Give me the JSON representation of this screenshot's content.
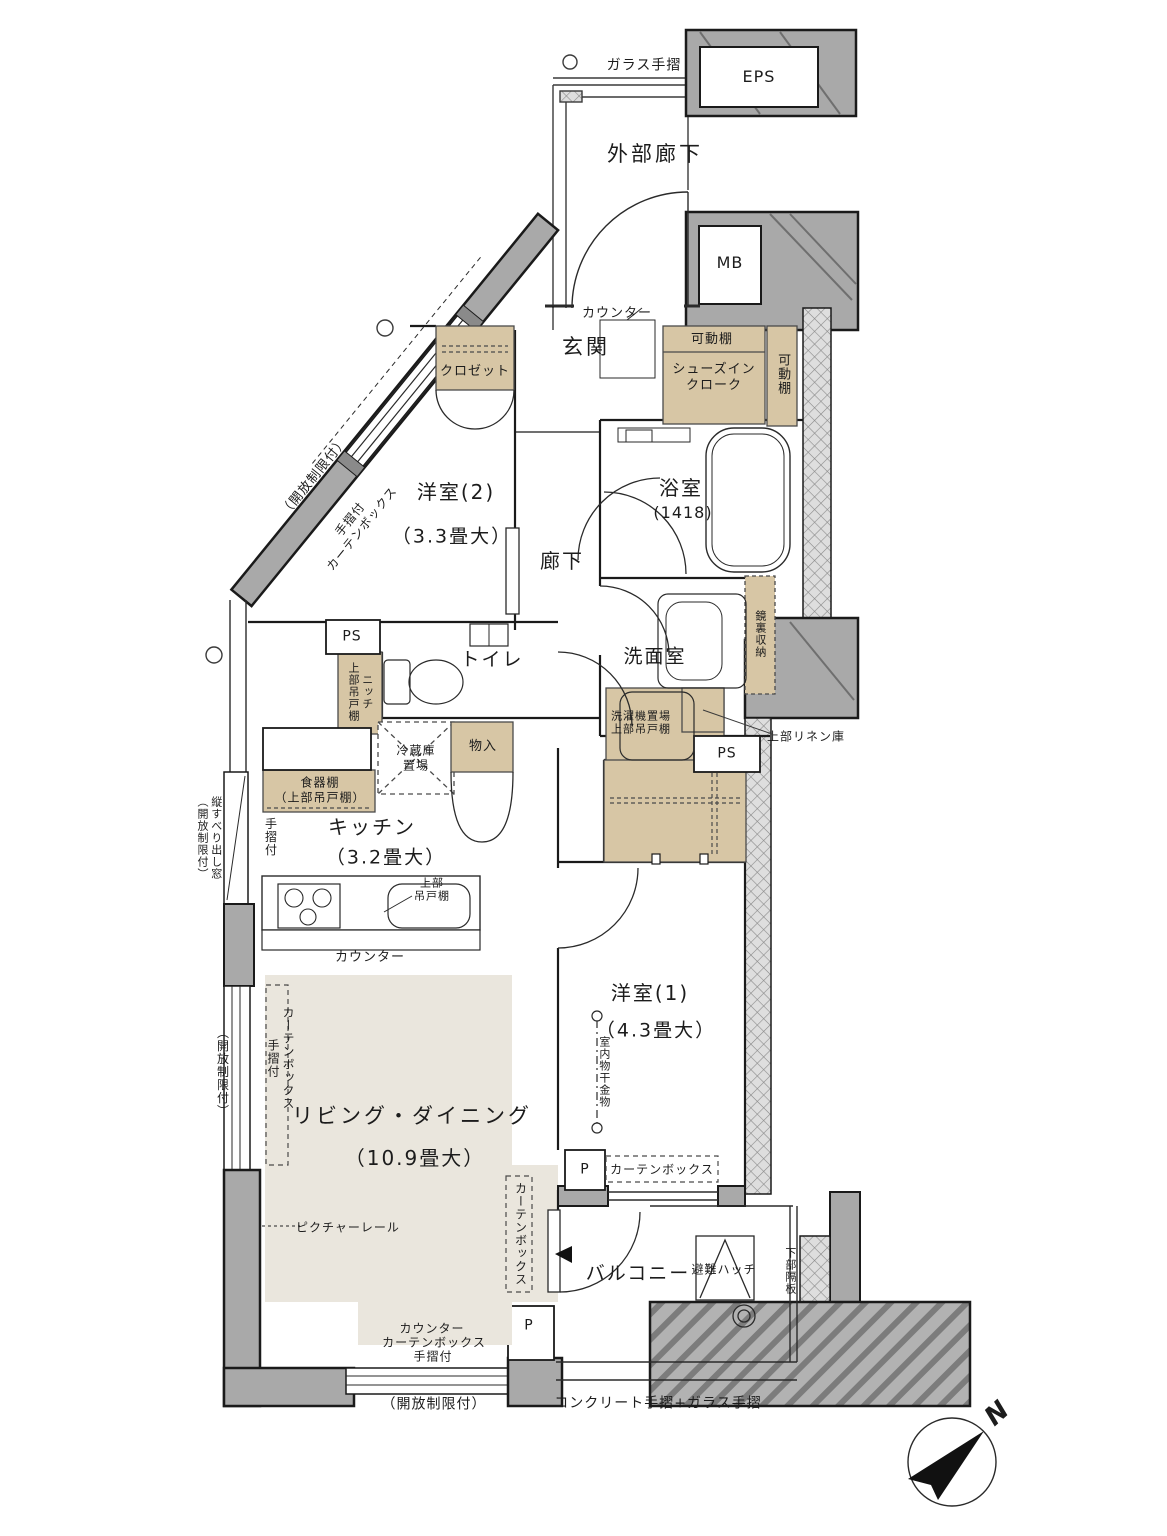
{
  "labels": {
    "glass_rail": "ガラス手摺",
    "eps": "EPS",
    "exterior_corridor": "外部廊下",
    "mb": "MB",
    "genkan_counter": "カウンター",
    "genkan": "玄関",
    "movable_shelf_top": "可動棚",
    "shoes_in_closet": "シューズイン\nクローク",
    "movable_shelf_side": "可動棚",
    "closet_w2": "クロゼット",
    "open_limit_diagonal": "（開放制限付）",
    "handrail_curtainbox_diagonal": "手摺付\nカーテンボックス",
    "western2": "洋室(2)",
    "western2_size": "（3.3畳大）",
    "hallway": "廊下",
    "bathroom": "浴室",
    "bathroom_size": "(1418)",
    "mirror_storage": "鏡裏収納",
    "ps_toilet": "PS",
    "niche_upper_cabinet": "ニッチ\n上部吊戸棚",
    "toilet": "トイレ",
    "washroom": "洗面室",
    "washer_upper_cabinet": "洗濯機置場\n上部吊戸棚",
    "ps_washroom": "PS",
    "linen_upper": "上部リネン庫",
    "fridge_space": "冷蔵庫\n置場",
    "storage": "物入",
    "dish_cabinet": "食器棚\n（上部吊戸棚）",
    "kitchen": "キッチン",
    "kitchen_size": "（3.2畳大）",
    "handrail_kitchen": "手摺付",
    "casement_window": "縦すべり出し窓\n（開放制限付）",
    "upper_cabinet_kitchen": "上部\n吊戸棚",
    "kitchen_counter": "カウンター",
    "curtainbox_handrail_left": "カーテンボックス\n手摺付",
    "open_limit_left": "（開放制限付）",
    "living_dining": "リビング・ダイニング",
    "living_dining_size": "（10.9畳大）",
    "picture_rail": "ピクチャーレール",
    "indoor_drying": "室内物干金物",
    "curtainbox_w1": "カーテンボックス",
    "p_w1": "P",
    "western1": "洋室(1)",
    "western1_size": "（4.3畳大）",
    "curtainbox_balcony": "カーテンボックス",
    "balcony": "バルコニー",
    "escape_hatch": "避難ハッチ",
    "lower_partition": "下部隔板",
    "counter_bottom": "カウンター",
    "curtainbox_bottom": "カーテンボックス",
    "handrail_bottom": "手摺付",
    "p_bottom": "P",
    "open_limit_bottom": "（開放制限付）",
    "concrete_rail": "コンクリート手摺+ガラス手摺",
    "compass_north": "N"
  },
  "colors": {
    "wall": "#a9a9a9",
    "storage": "#d7c6a5",
    "floor_living": "#eae6dd",
    "line": "#1a1a1a"
  }
}
